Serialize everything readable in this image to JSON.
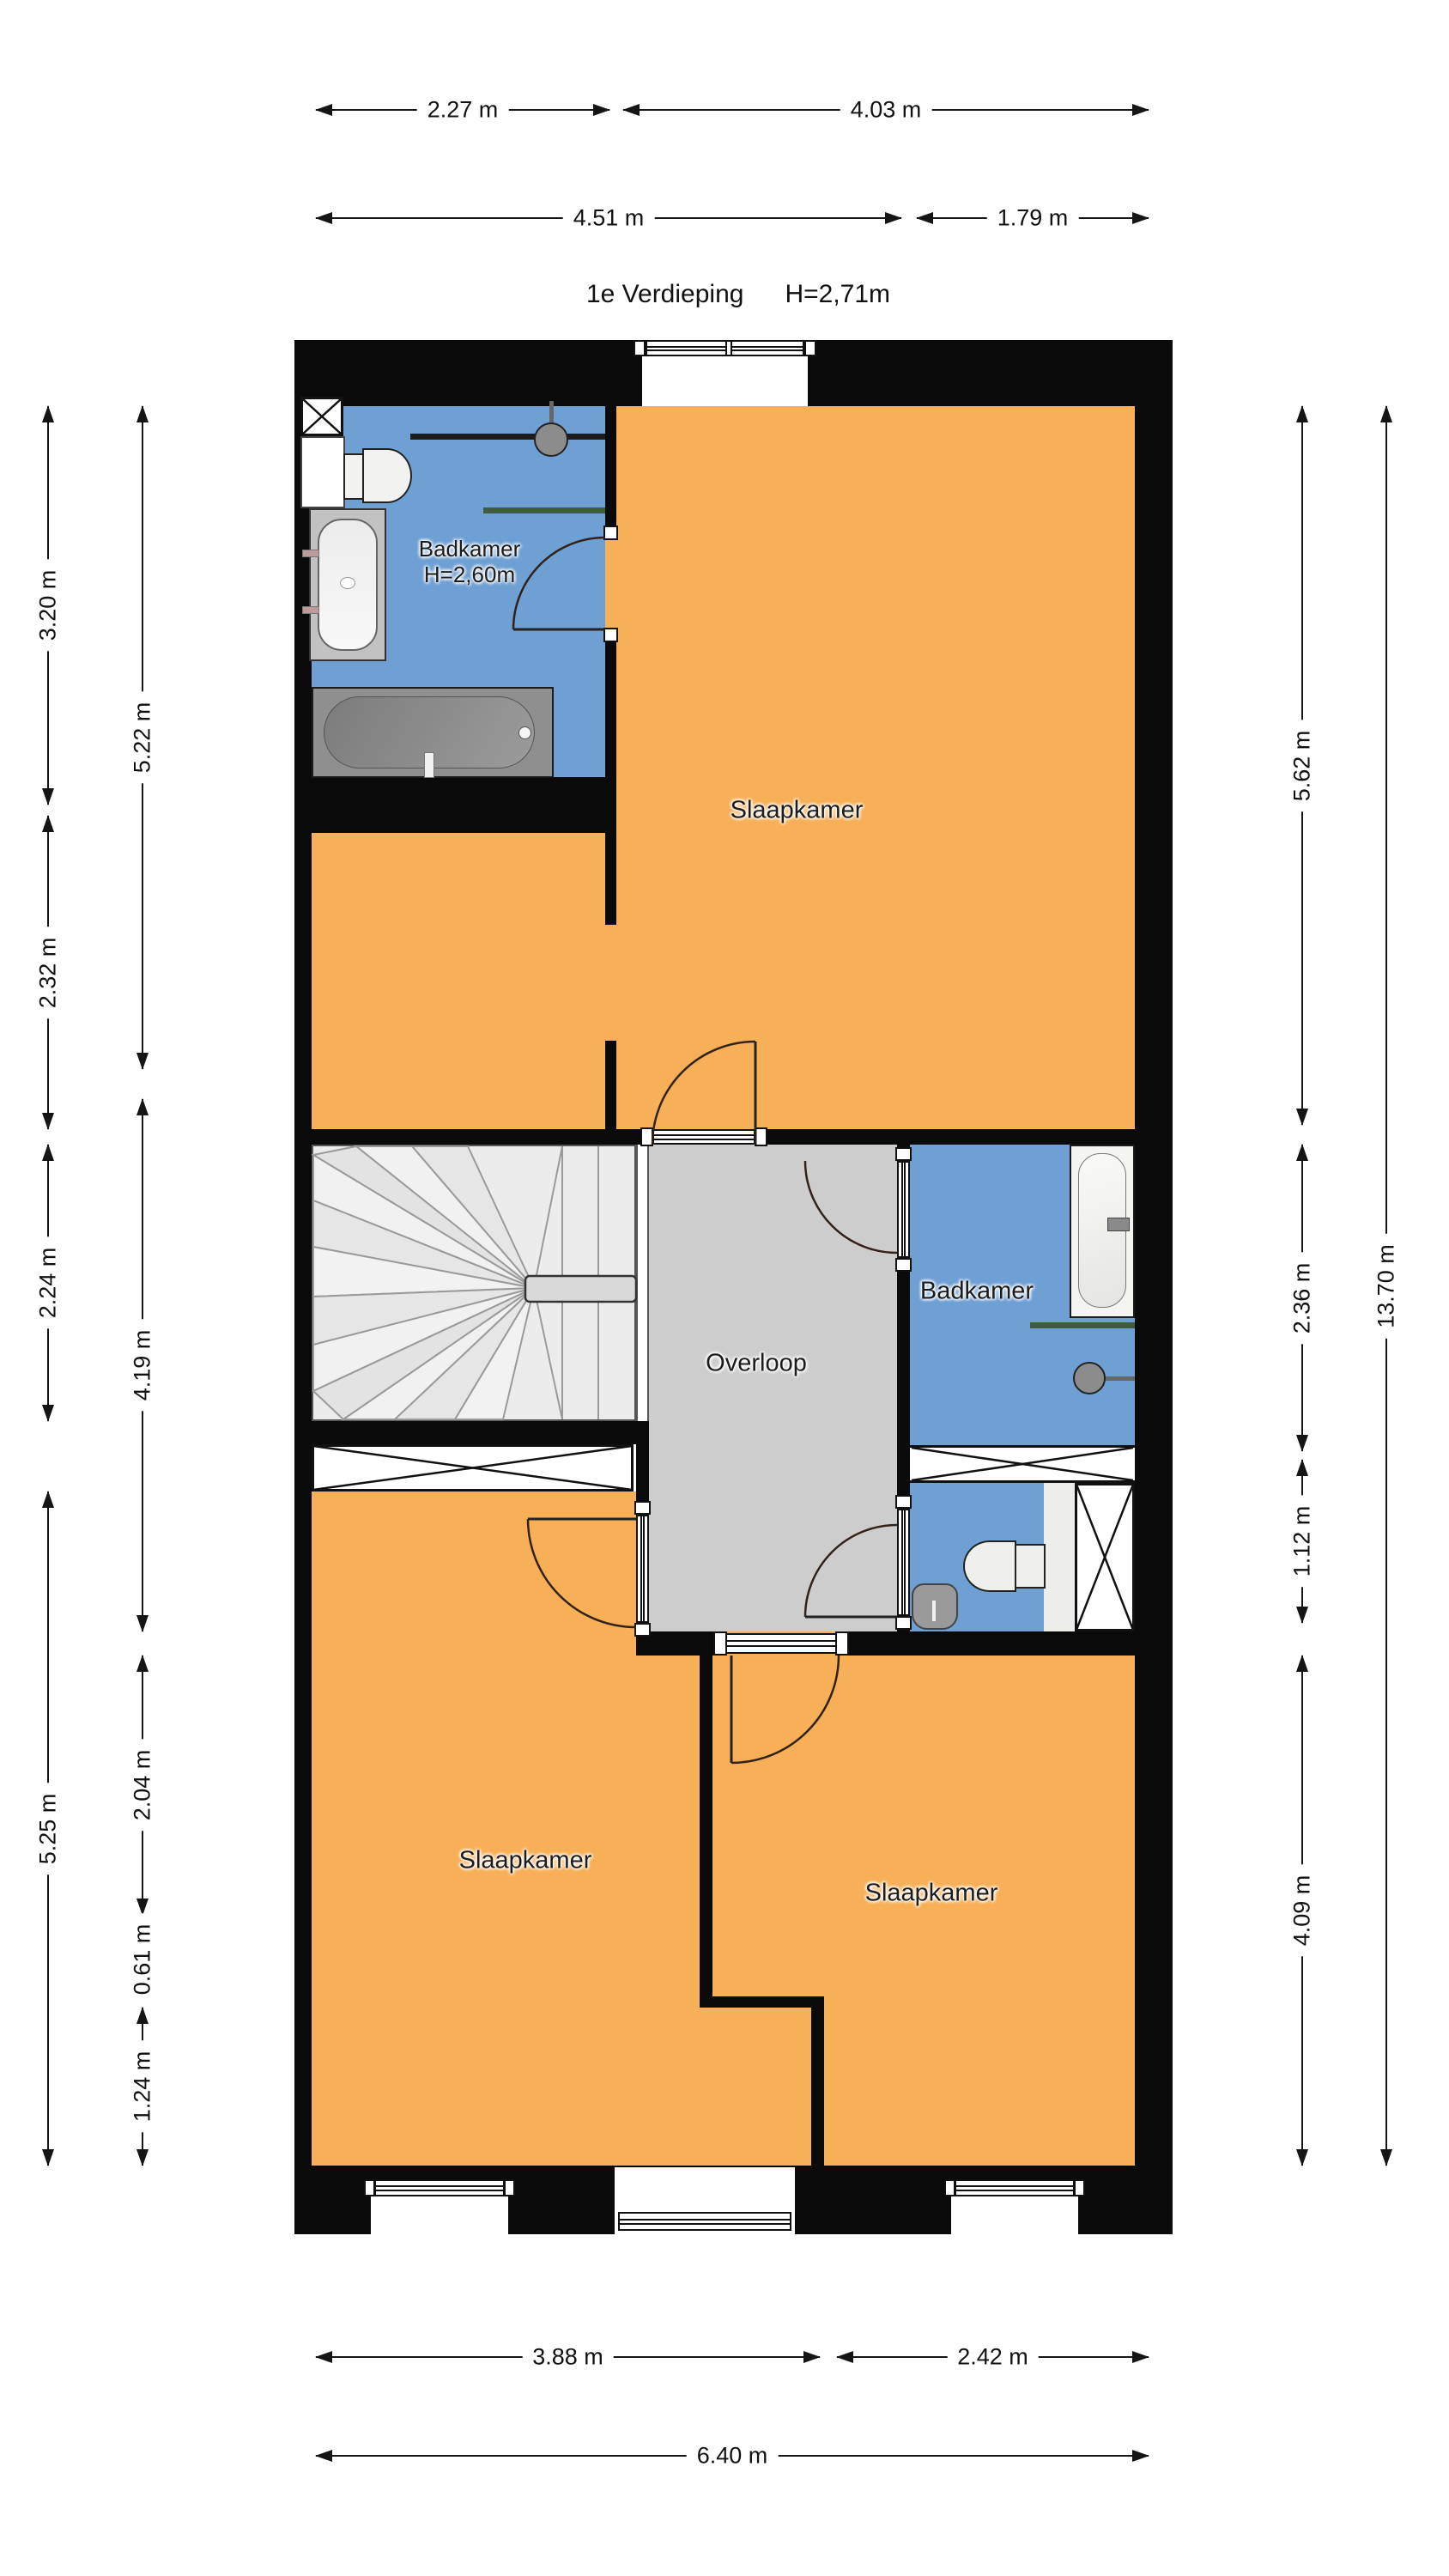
{
  "header": {
    "title": "1e Verdieping",
    "ceiling_height": "H=2,71m"
  },
  "rooms": {
    "badkamer_top": {
      "label": "Badkamer",
      "height": "H=2,60m"
    },
    "slaapkamer_top": {
      "label": "Slaapkamer"
    },
    "overloop": {
      "label": "Overloop"
    },
    "badkamer_mid": {
      "label": "Badkamer"
    },
    "slaapkamer_left": {
      "label": "Slaapkamer"
    },
    "slaapkamer_right": {
      "label": "Slaapkamer"
    }
  },
  "dimensions": {
    "top": [
      "2.27 m",
      "4.03 m",
      "4.51 m",
      "1.79 m"
    ],
    "bottom": [
      "3.88 m",
      "2.42 m",
      "6.40 m"
    ],
    "left_outer": [
      "3.20 m",
      "2.32 m",
      "2.24 m",
      "5.25 m"
    ],
    "left_inner": [
      "5.22 m",
      "4.19 m",
      "2.04 m",
      "0.61 m",
      "1.24 m"
    ],
    "right_inner": [
      "5.62 m",
      "2.36 m",
      "1.12 m",
      "4.09 m"
    ],
    "right_outer": [
      "13.70 m"
    ]
  },
  "colors": {
    "bedroom_orange": "#F7B057",
    "bathroom_blue": "#6FA0D4",
    "landing_gray": "#CDCDCD",
    "stairs_gray": "#ECECEC",
    "wall_black": "#0A0A0A",
    "glass_green": "#3E5C40"
  },
  "icons": [
    "bathtub-icon",
    "toilet-icon",
    "sink-icon",
    "shower-head-icon",
    "stairs-icon",
    "duct-x-icon",
    "void-x-icon",
    "door-arc-icon",
    "window-icon"
  ]
}
